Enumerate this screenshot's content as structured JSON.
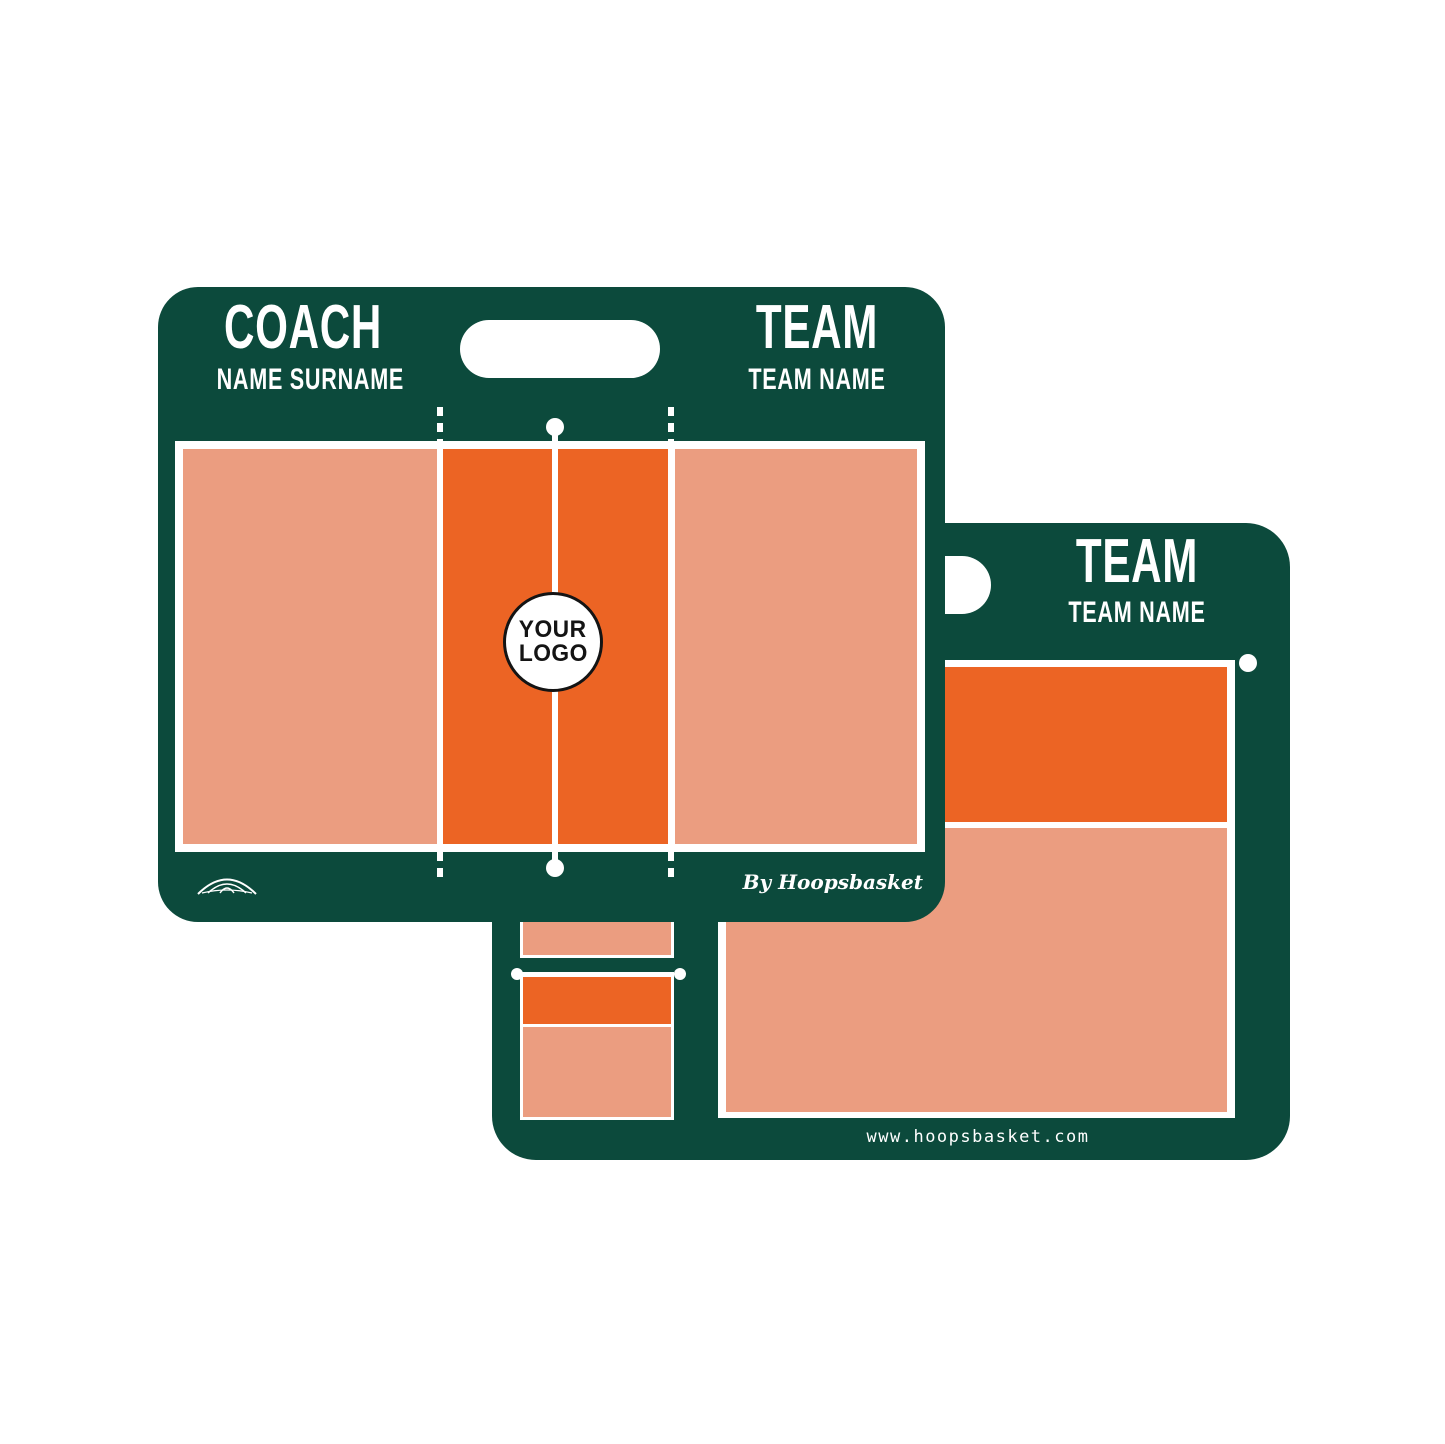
{
  "colors": {
    "board_green": "#0c4a3c",
    "court_orange": "#ec6424",
    "court_salmon": "#eb9d80",
    "line_white": "#ffffff",
    "logo_ink": "#141414"
  },
  "front_board": {
    "coach_heading": "COACH",
    "coach_subheading": "NAME SURNAME",
    "team_heading": "TEAM",
    "team_subheading": "TEAM NAME",
    "logo_placeholder_line1": "YOUR",
    "logo_placeholder_line2": "LOGO",
    "byline": "By Hoopsbasket",
    "icons": {
      "brand": "basketball-icon",
      "handle": "handle-cutout"
    }
  },
  "back_board": {
    "team_heading": "TEAM",
    "team_subheading": "TEAM NAME",
    "website": "www.hoopsbasket.com",
    "icons": {
      "handle": "handle-cutout"
    }
  }
}
